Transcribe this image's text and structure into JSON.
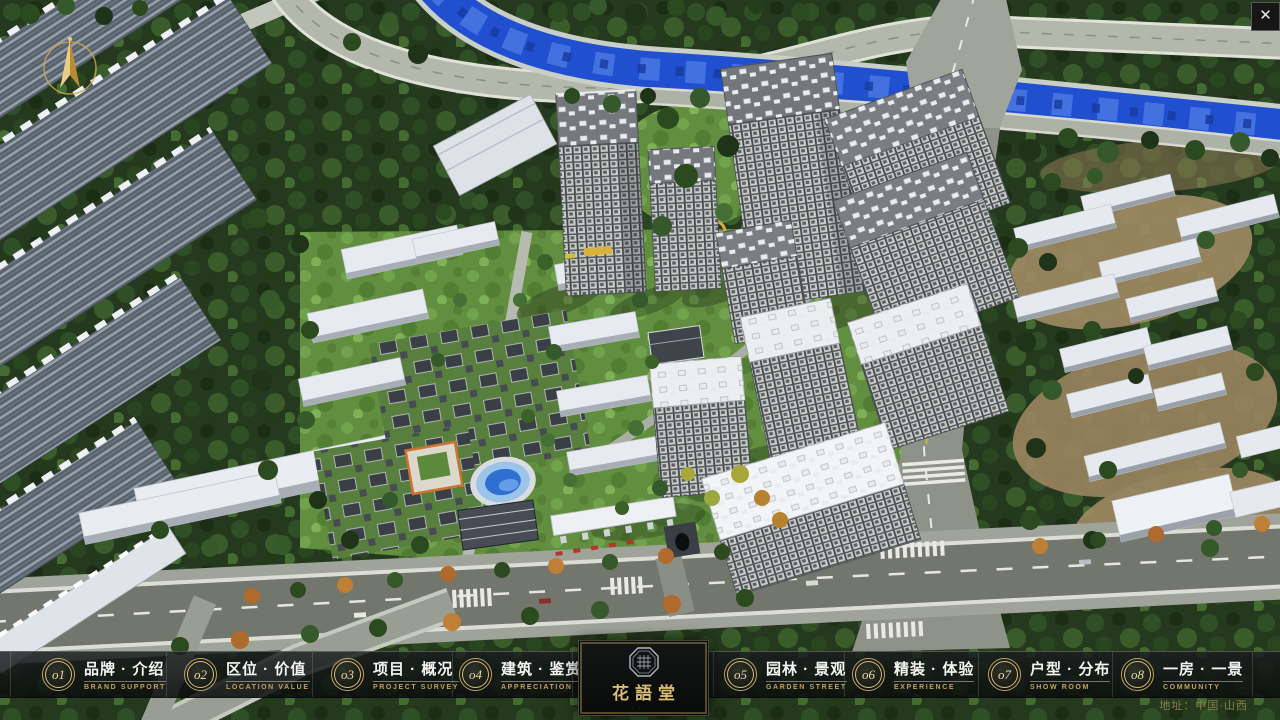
{
  "window": {
    "close_glyph": "✕"
  },
  "logo": {
    "name_zh": "花語堂",
    "tagline": "· · · · · · · ·"
  },
  "footer": {
    "address": "地址：中国·山西"
  },
  "nav": {
    "items": [
      {
        "id": "o1",
        "zh": "品牌 · 介绍",
        "en": "BRAND SUPPORT"
      },
      {
        "id": "o2",
        "zh": "区位 · 价值",
        "en": "LOCATION VALUE"
      },
      {
        "id": "o3",
        "zh": "项目 · 概况",
        "en": "PROJECT SURVEY"
      },
      {
        "id": "o4",
        "zh": "建筑 · 鉴赏",
        "en": "APPRECIATION"
      },
      {
        "id": "o5",
        "zh": "园林 · 景观",
        "en": "GARDEN STREET"
      },
      {
        "id": "o6",
        "zh": "精装 · 体验",
        "en": "EXPERIENCE"
      },
      {
        "id": "o7",
        "zh": "户型 · 分布",
        "en": "SHOW ROOM"
      },
      {
        "id": "o8",
        "zh": "一房 · 一景",
        "en": "COMMUNITY"
      }
    ]
  },
  "colors": {
    "gold": "#c2a35c",
    "river": "#2050cf",
    "bar_bg": "rgba(18,22,24,0.82)"
  }
}
